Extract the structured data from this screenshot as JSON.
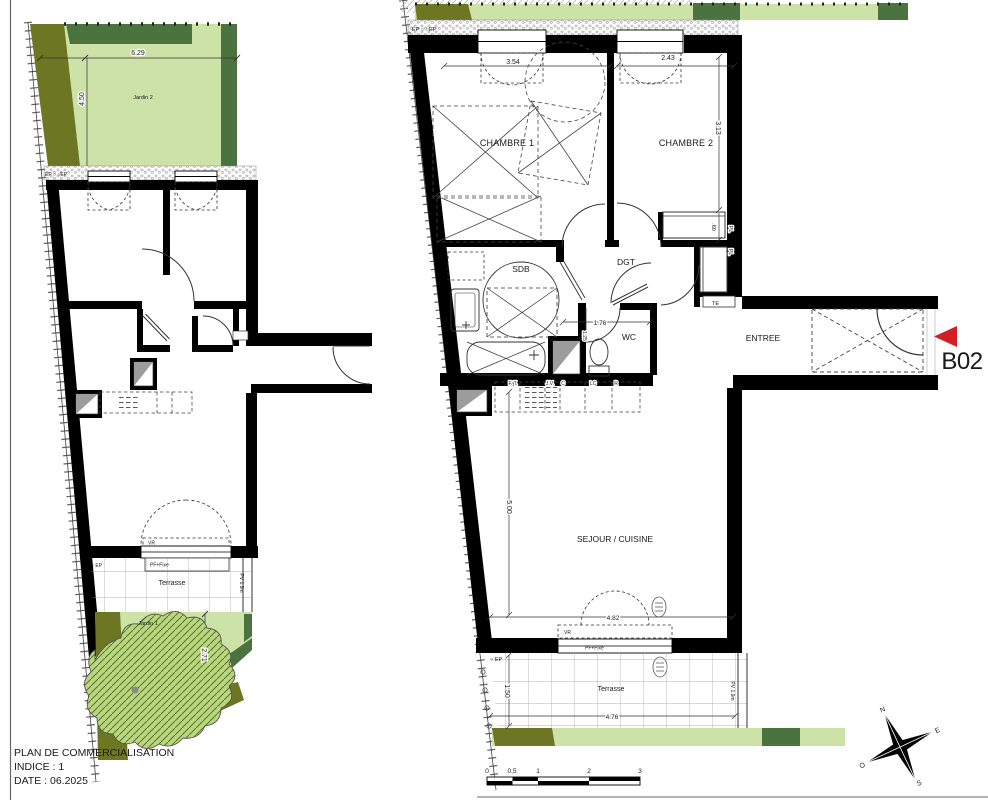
{
  "colors": {
    "wall": "#000000",
    "lawn_light": "#cde2a6",
    "lawn_dark": "#4a7340",
    "olive": "#6d7623",
    "tree_fill": "#bad77f",
    "red_marker": "#d21f26",
    "text": "#1a1a1a"
  },
  "title_block": {
    "line1": "PLAN DE COMMERCIALISATION",
    "line2": "INDICE : 1",
    "line3": "DATE :  06.2025"
  },
  "unit": {
    "label": "B02"
  },
  "compass": {
    "n": "N",
    "e": "E",
    "s": "S",
    "o": "O"
  },
  "scale_bar": {
    "t0": "0",
    "t05": "0,5",
    "t1": "1",
    "t2": "2",
    "t3": "3"
  },
  "window_labels": {
    "vr": "VR",
    "pf": "PF+Fixe"
  },
  "left_plan": {
    "jardin2_label": "Jardin 2",
    "jardin1_label": "Jardin 1",
    "terrasse_label": "Terrasse",
    "pv_label": "PV 1.9m",
    "ep_band_label": "EP ○  ○EP",
    "ep_label": "○ EP",
    "dim_width": "6.29",
    "dim_height": "4.50",
    "dim_jardin1": "2.71"
  },
  "b02_plan": {
    "ep_band_label": "EP ○  ○EP",
    "ep_label": "○ EP",
    "rooms": {
      "chambre1": "CHAMBRE 1",
      "chambre2": "CHAMBRE 2",
      "sdb": "SDB",
      "dgt": "DGT",
      "wc": "WC",
      "entree": "ENTREE",
      "sejour": "SEJOUR / CUISINE",
      "terrasse": "Terrasse"
    },
    "closets": {
      "pl1": "PL",
      "pl2": "PL",
      "te": "TE"
    },
    "dims": {
      "win1": "3.54",
      "win2": "2.43",
      "ch2_h": "3.13",
      "pl": ".60",
      "wc_w": "1.76",
      "wc_d": "1.25",
      "sejour_h": "5.00",
      "sejour_w": "4.82",
      "terr_d": "1.50",
      "terr_w": "4.76"
    },
    "pv_label": "PV 1.9m",
    "kitchen": [
      "F. T.",
      "J.V.",
      "C",
      "LC",
      "R"
    ]
  }
}
